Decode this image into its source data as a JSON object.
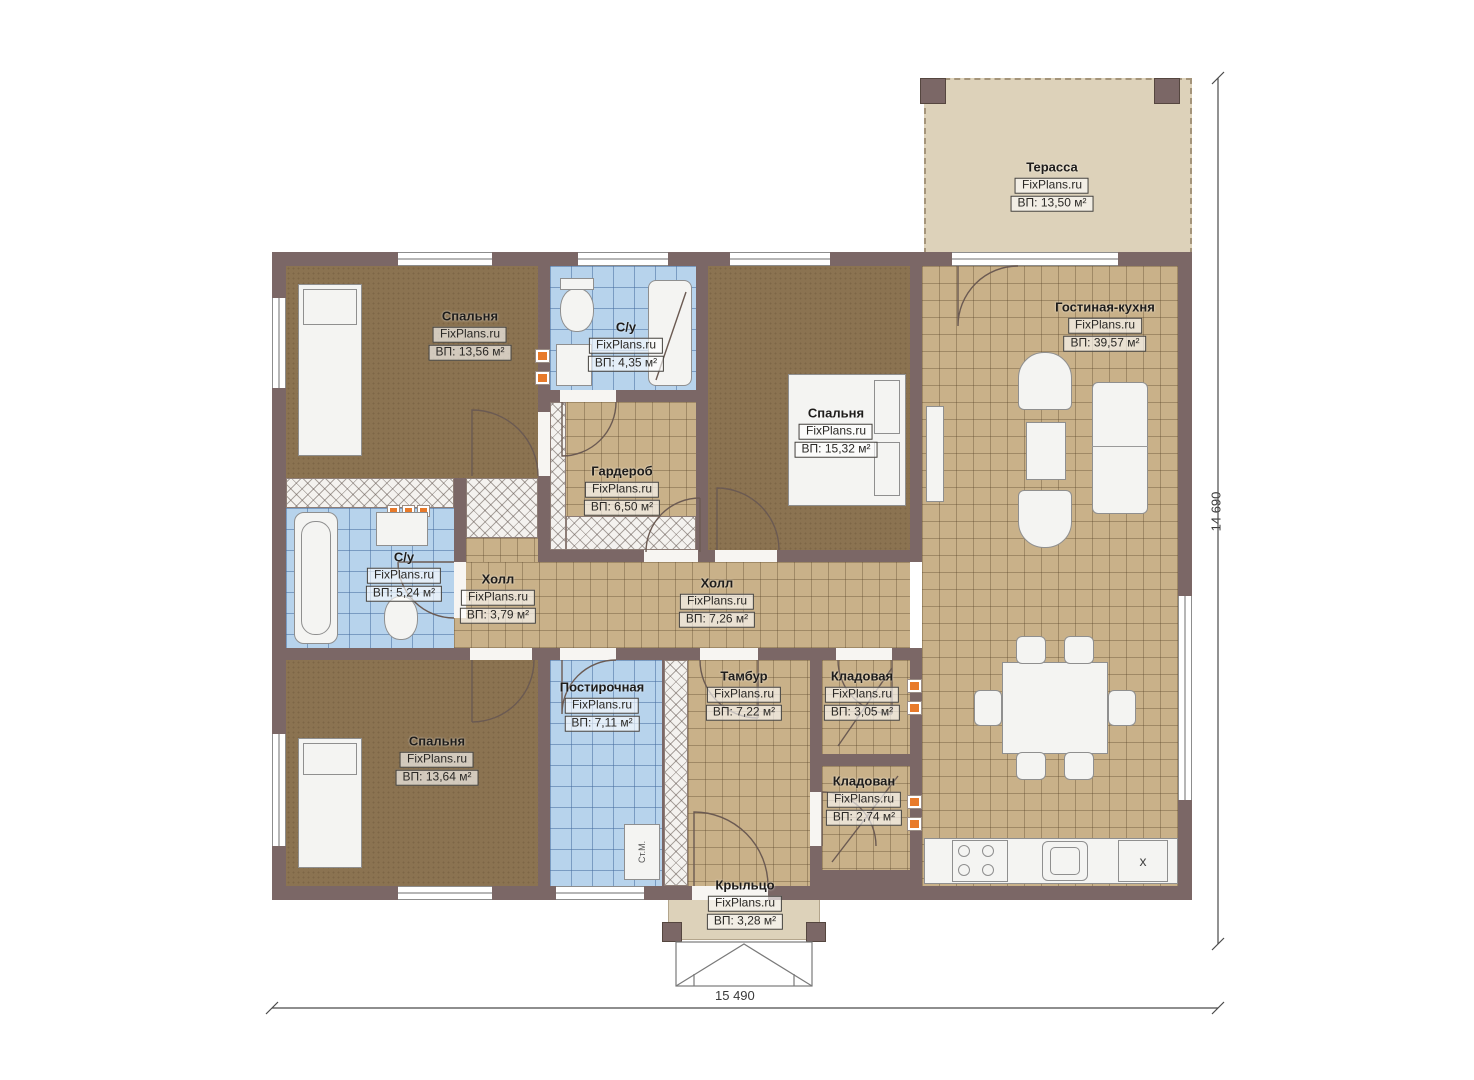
{
  "watermark": "FixPlans.ru",
  "rooms": {
    "terrace": {
      "name": "Терасса",
      "area": "ВП: 13,50 м²"
    },
    "bedroom_tl": {
      "name": "Спальня",
      "area": "ВП: 13,56 м²"
    },
    "bath_top": {
      "name": "С/у",
      "area": "ВП: 4,35 м²"
    },
    "bedroom_r": {
      "name": "Спальня",
      "area": "ВП: 15,32 м²"
    },
    "living_kitchen": {
      "name": "Гостиная-кухня",
      "area": "ВП: 39,57 м²"
    },
    "wardrobe": {
      "name": "Гардероб",
      "area": "ВП: 6,50 м²"
    },
    "bath_left": {
      "name": "С/у",
      "area": "ВП: 5,24 м²"
    },
    "hall_small": {
      "name": "Холл",
      "area": "ВП: 3,79 м²"
    },
    "hall_main": {
      "name": "Холл",
      "area": "ВП: 7,26 м²"
    },
    "bedroom_bl": {
      "name": "Спальня",
      "area": "ВП: 13,64 м²"
    },
    "laundry": {
      "name": "Постирочная",
      "area": "ВП: 7,11 м²"
    },
    "vestibule": {
      "name": "Тамбур",
      "area": "ВП: 7,22 м²"
    },
    "storage_1": {
      "name": "Кладовая",
      "area": "ВП: 3,05 м²"
    },
    "storage_2": {
      "name": "Кладован",
      "area": "ВП: 2,74 м²"
    },
    "porch": {
      "name": "Крыльцо",
      "area": "ВП: 3,28 м²"
    }
  },
  "dimensions": {
    "bottom": "15 490",
    "right": "14 690"
  },
  "markers": {
    "washing_machine": "Ст.М.",
    "fridge": "x"
  },
  "colors": {
    "wall": "#7b6766",
    "floor_brown": "#8b7351",
    "floor_tile": "#c9b189",
    "floor_blue": "#b7d3ec",
    "floor_beige": "#ddd2ba",
    "accent_vent": "#e87a2a"
  }
}
